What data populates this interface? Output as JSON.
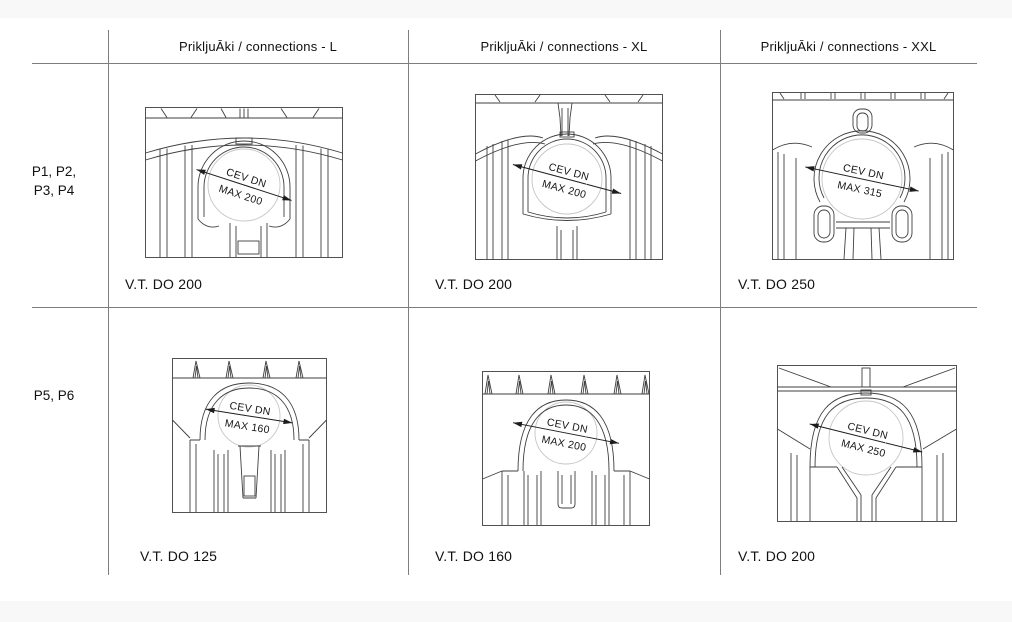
{
  "colors": {
    "background": "#ffffff",
    "band": "#f8f8f8",
    "grid_line": "#7d7d7d",
    "drawing_line": "#3f3f3f",
    "construction_circle": "#c6c6c6",
    "text": "#111111"
  },
  "table": {
    "columns": [
      {
        "id": "L",
        "header": "PrikljuĀki / connections - L"
      },
      {
        "id": "XL",
        "header": "PrikljuĀki / connections - XL"
      },
      {
        "id": "XXL",
        "header": "PrikljuĀki / connections - XXL"
      }
    ],
    "rows": [
      {
        "label_line1": "P1, P2,",
        "label_line2": "P3, P4",
        "cells": [
          {
            "dim_line1": "CEV DN",
            "dim_line2": "MAX 200",
            "caption": "V.T. DO 200"
          },
          {
            "dim_line1": "CEV DN",
            "dim_line2": "MAX 200",
            "caption": "V.T. DO 200"
          },
          {
            "dim_line1": "CEV DN",
            "dim_line2": "MAX 315",
            "caption": "V.T. DO 250"
          }
        ]
      },
      {
        "label_line1": "P5, P6",
        "label_line2": "",
        "cells": [
          {
            "dim_line1": "CEV DN",
            "dim_line2": "MAX 160",
            "caption": "V.T. DO 125"
          },
          {
            "dim_line1": "CEV DN",
            "dim_line2": "MAX 200",
            "caption": "V.T. DO 160"
          },
          {
            "dim_line1": "CEV DN",
            "dim_line2": "MAX 250",
            "caption": "V.T. DO 200"
          }
        ]
      }
    ]
  }
}
